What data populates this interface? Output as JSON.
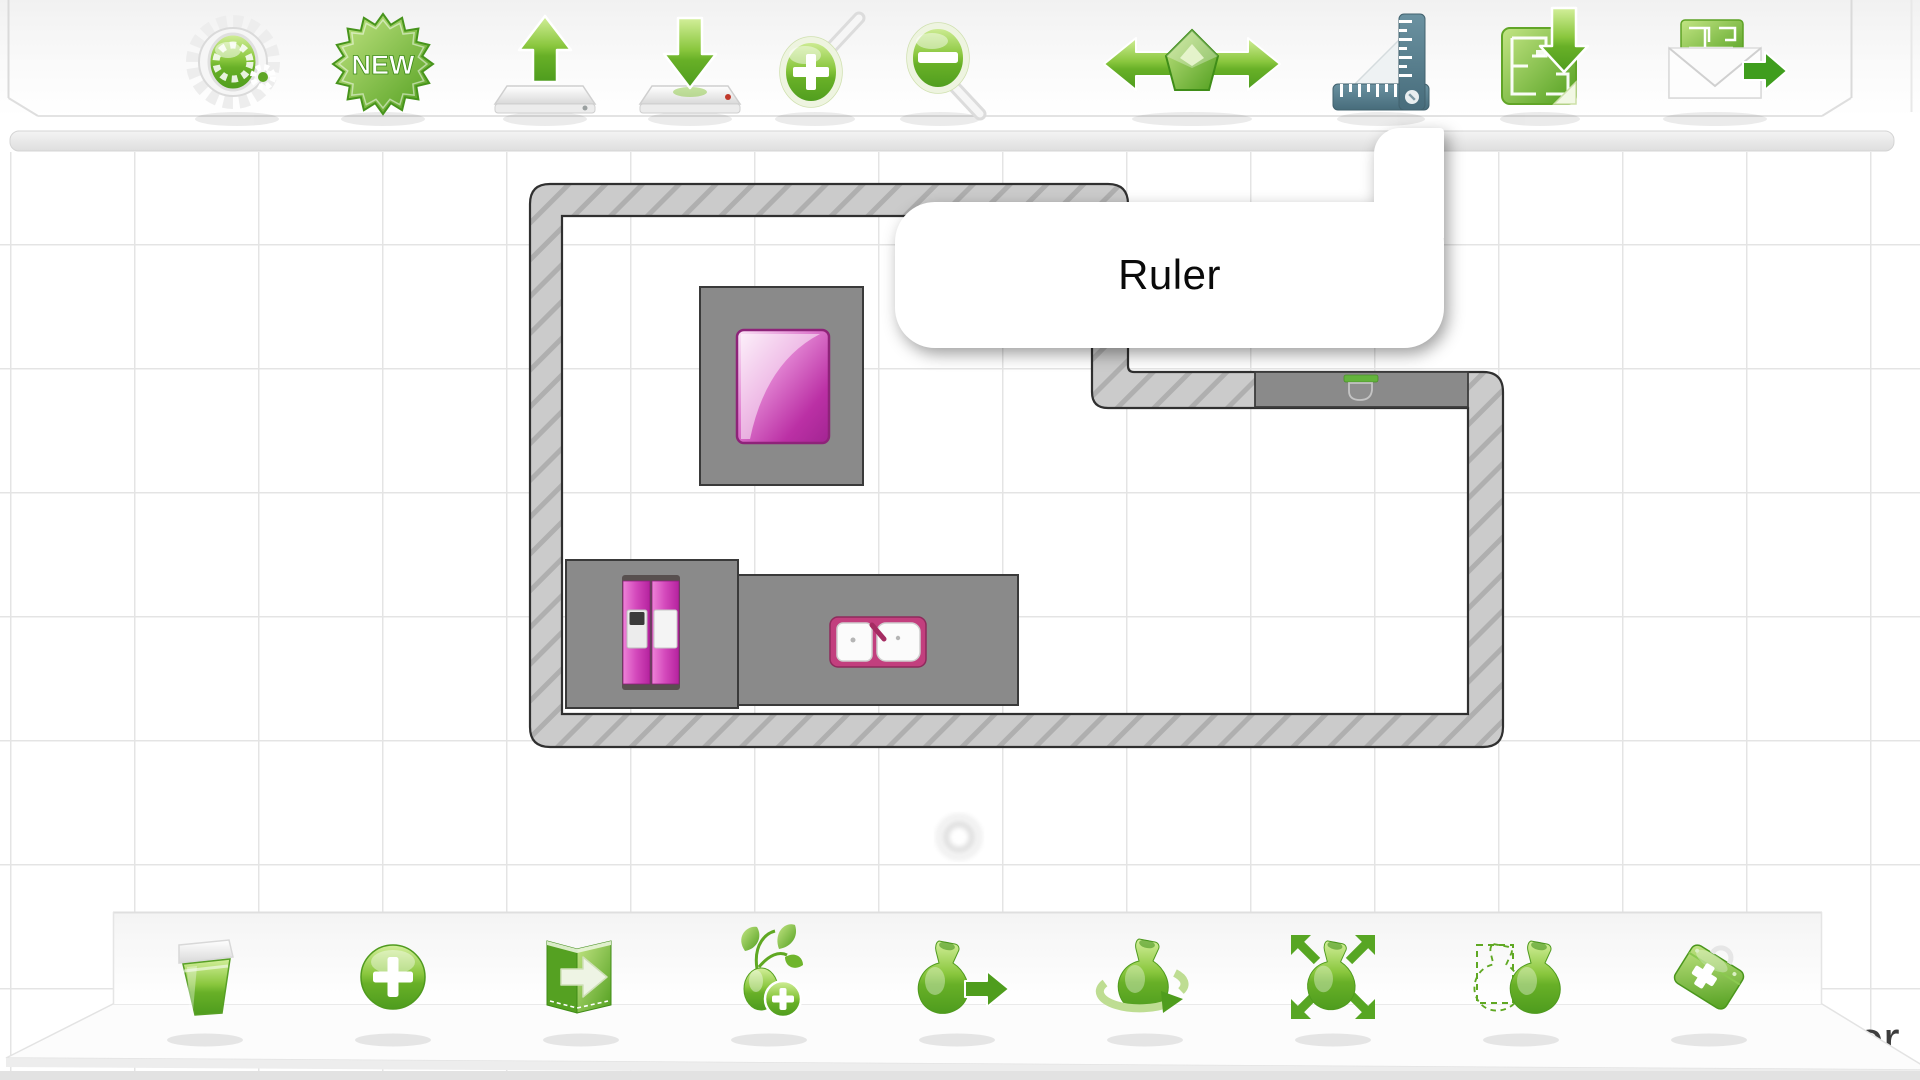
{
  "top_toolbar": {
    "new_badge_label": "NEW",
    "items": [
      {
        "id": "settings",
        "icon": "gears-icon"
      },
      {
        "id": "new-plan",
        "icon": "new-badge-icon"
      },
      {
        "id": "save-plan",
        "icon": "arrow-up-tray-icon"
      },
      {
        "id": "load-plan",
        "icon": "arrow-down-tray-icon"
      },
      {
        "id": "zoom-in",
        "icon": "magnifier-plus-icon"
      },
      {
        "id": "zoom-out",
        "icon": "magnifier-minus-icon"
      },
      {
        "id": "flip-horizontal",
        "icon": "left-right-arrows-gem-icon"
      },
      {
        "id": "ruler",
        "icon": "ruler-icon",
        "tooltip": "Ruler"
      },
      {
        "id": "import-plan-image",
        "icon": "floor-plan-download-icon"
      },
      {
        "id": "send-plan",
        "icon": "envelope-arrow-icon"
      }
    ]
  },
  "tooltip": {
    "text": "Ruler",
    "anchor": "ruler"
  },
  "bottom_toolbar": {
    "items": [
      {
        "id": "delete-object",
        "icon": "trash-icon"
      },
      {
        "id": "add-object",
        "icon": "plus-circle-icon"
      },
      {
        "id": "export-book",
        "icon": "book-arrow-icon"
      },
      {
        "id": "add-furniture",
        "icon": "plant-plus-icon"
      },
      {
        "id": "move-object",
        "icon": "vase-arrow-icon"
      },
      {
        "id": "rotate-object",
        "icon": "vase-rotate-icon"
      },
      {
        "id": "scale-object",
        "icon": "vase-expand-arrows-icon"
      },
      {
        "id": "duplicate-object",
        "icon": "vase-duplicate-icon"
      },
      {
        "id": "toolbox",
        "icon": "first-aid-kit-icon"
      }
    ]
  },
  "canvas": {
    "partial_text": "or",
    "grid": {
      "spacing_px": 124,
      "line_color": "#e4e4e4"
    },
    "plan": {
      "rooms": 2,
      "objects": [
        "table-with-purple-top",
        "fridge",
        "fridge-counter",
        "sink-counter",
        "sink",
        "wall-counter",
        "toilet",
        "origin-marker"
      ],
      "wall_fill": "#cbcbcb",
      "wall_hatch": "#a5a5a5",
      "furniture_gray": "#8a8a8a",
      "accent_purple": "#b32c9e",
      "sink_pink": "#c23f7e"
    }
  },
  "colors": {
    "accent_green": "#6ab52c",
    "ruler_slate": "#557d8d",
    "toolbar_bg": "#f7f7f7"
  }
}
